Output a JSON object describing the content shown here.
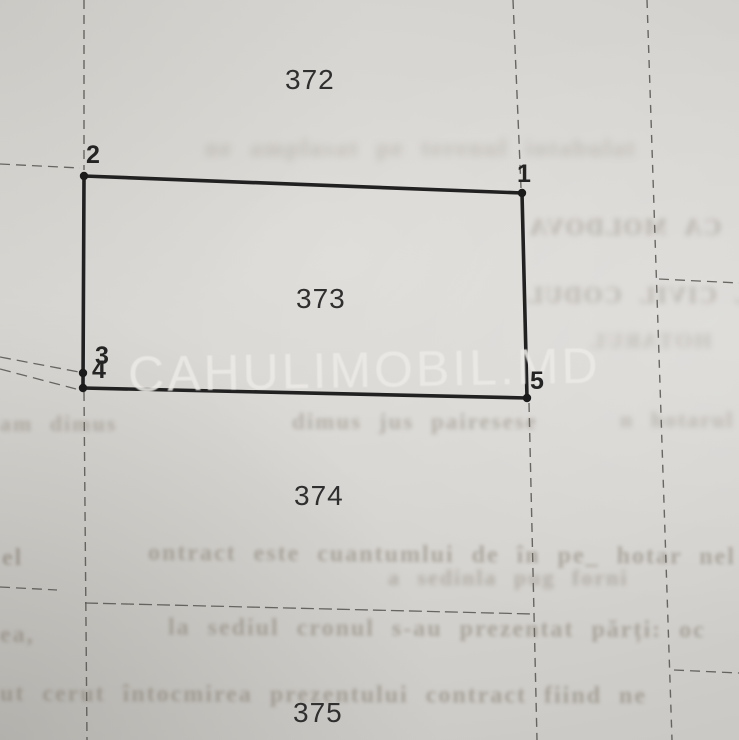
{
  "document": {
    "type_label": "cadastral plan scan",
    "watermark": {
      "text": "CAHULIMOBIL.MD"
    }
  },
  "colors": {
    "paper": "#d5d3cf",
    "solid_boundary": "#212121",
    "dashed_boundary": "#55534f",
    "survey_dot": "#1b1b1b",
    "parcel_text": "#2f2f2f",
    "point_text": "#242424",
    "watermark_text": "#eceae6",
    "bleed_text": "#7d766a"
  },
  "parcels": [
    {
      "label": "372",
      "x": 285,
      "y": 64
    },
    {
      "label": "373",
      "x": 296,
      "y": 283
    },
    {
      "label": "374",
      "x": 294,
      "y": 480
    },
    {
      "label": "375",
      "x": 293,
      "y": 697
    }
  ],
  "points": [
    {
      "label": "1",
      "x": 517,
      "y": 160
    },
    {
      "label": "2",
      "x": 86,
      "y": 141
    },
    {
      "label": "3",
      "x": 95,
      "y": 342
    },
    {
      "label": "4",
      "x": 92,
      "y": 356
    },
    {
      "label": "5",
      "x": 530,
      "y": 367
    }
  ],
  "map": {
    "parcel_polygon": [
      [
        84,
        176
      ],
      [
        522,
        193
      ],
      [
        527,
        398
      ],
      [
        83,
        388
      ]
    ],
    "polygon_stroke_width": 3.6,
    "survey_dots": [
      {
        "x": 84,
        "y": 176
      },
      {
        "x": 522,
        "y": 193
      },
      {
        "x": 527,
        "y": 398
      },
      {
        "x": 83,
        "y": 388
      },
      {
        "x": 83,
        "y": 373
      }
    ],
    "dot_radius": 4.2,
    "dashed_lines": [
      {
        "x1": 84,
        "y1": 0,
        "x2": 84,
        "y2": 170,
        "dash": "9 6",
        "w": 1.4
      },
      {
        "x1": 84,
        "y1": 392,
        "x2": 87,
        "y2": 740,
        "dash": "9 6",
        "w": 1.4
      },
      {
        "x1": 513,
        "y1": 0,
        "x2": 521,
        "y2": 188,
        "dash": "9 6",
        "w": 1.4
      },
      {
        "x1": 529,
        "y1": 403,
        "x2": 537,
        "y2": 740,
        "dash": "9 6",
        "w": 1.4
      },
      {
        "x1": 647,
        "y1": 0,
        "x2": 672,
        "y2": 740,
        "dash": "8 7",
        "w": 1.4
      },
      {
        "x1": 0,
        "y1": 164,
        "x2": 80,
        "y2": 168,
        "dash": "10 6",
        "w": 1.3
      },
      {
        "x1": 0,
        "y1": 357,
        "x2": 79,
        "y2": 372,
        "dash": "11 6",
        "w": 1.3
      },
      {
        "x1": 0,
        "y1": 369,
        "x2": 76,
        "y2": 389,
        "dash": "11 6",
        "w": 1.3
      },
      {
        "x1": 0,
        "y1": 587,
        "x2": 57,
        "y2": 590,
        "dash": "10 6",
        "w": 1.3
      },
      {
        "x1": 85,
        "y1": 603,
        "x2": 533,
        "y2": 614,
        "dash": "13 5",
        "w": 1.3
      },
      {
        "x1": 659,
        "y1": 279,
        "x2": 739,
        "y2": 283,
        "dash": "10 6",
        "w": 1.3
      },
      {
        "x1": 674,
        "y1": 670,
        "x2": 739,
        "y2": 673,
        "dash": "10 6",
        "w": 1.3
      }
    ]
  },
  "bleed_through_rows": [
    {
      "text": "ne amplasat pe terenul intabulat",
      "x": 205,
      "y": 136,
      "fs": 24,
      "blur": 4.0,
      "op": 0.28,
      "mirror": false,
      "rot": 0
    },
    {
      "text": "CA MOLDOVA",
      "x": 528,
      "y": 215,
      "fs": 24,
      "blur": 2.6,
      "op": 0.38,
      "mirror": true,
      "rot": 0
    },
    {
      "text": "L CIVIL CODUL",
      "x": 525,
      "y": 283,
      "fs": 24,
      "blur": 2.6,
      "op": 0.36,
      "mirror": true,
      "rot": 0
    },
    {
      "text": "HOTARUL",
      "x": 588,
      "y": 328,
      "fs": 22,
      "blur": 3.2,
      "op": 0.28,
      "mirror": true,
      "rot": 0
    },
    {
      "text": "am dimus",
      "x": 0,
      "y": 411,
      "fs": 22,
      "blur": 2.2,
      "op": 0.42,
      "mirror": false,
      "rot": 0
    },
    {
      "text": "dimus jus pairesese",
      "x": 292,
      "y": 409,
      "fs": 23,
      "blur": 2.2,
      "op": 0.42,
      "mirror": false,
      "rot": 0
    },
    {
      "text": "n hotarul",
      "x": 620,
      "y": 407,
      "fs": 22,
      "blur": 2.8,
      "op": 0.34,
      "mirror": false,
      "rot": 0
    },
    {
      "text": "el",
      "x": 2,
      "y": 545,
      "fs": 24,
      "blur": 1.6,
      "op": 0.55,
      "mirror": false,
      "rot": 0
    },
    {
      "text": "ontract este cuantumlui de în pe_ hotar nel",
      "x": 148,
      "y": 542,
      "fs": 24,
      "blur": 1.9,
      "op": 0.48,
      "mirror": false,
      "rot": 0.4
    },
    {
      "text": "a sedinla pug forni",
      "x": 388,
      "y": 565,
      "fs": 22,
      "blur": 2.3,
      "op": 0.4,
      "mirror": false,
      "rot": 0
    },
    {
      "text": "ea,",
      "x": 0,
      "y": 622,
      "fs": 24,
      "blur": 1.9,
      "op": 0.5,
      "mirror": false,
      "rot": 0
    },
    {
      "text": "la sediul cronul s-au prezentat părți: oc",
      "x": 168,
      "y": 616,
      "fs": 24,
      "blur": 1.9,
      "op": 0.48,
      "mirror": false,
      "rot": 0.3
    },
    {
      "text": "ut cerut întocmirea prezentului contract fiind ne",
      "x": 0,
      "y": 682,
      "fs": 24,
      "blur": 1.9,
      "op": 0.5,
      "mirror": false,
      "rot": 0.2
    }
  ]
}
